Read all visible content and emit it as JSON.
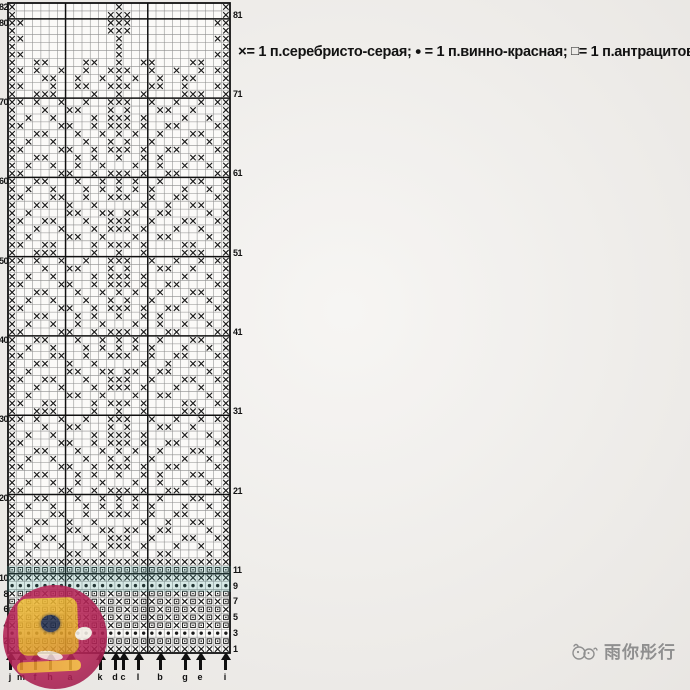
{
  "page": {
    "background": "#f2f0ed"
  },
  "legend": {
    "items": [
      {
        "symbol": "×",
        "icon": "x-stitch-icon",
        "label": "= 1 п.серебристо-серая;"
      },
      {
        "symbol": "•",
        "icon": "dot-stitch-icon",
        "label": "= 1 п.винно-красная;"
      },
      {
        "symbol": "□",
        "icon": "square-stitch-icon",
        "label": "= 1 п.антрацитовая"
      }
    ]
  },
  "watermark": {
    "text": "雨你彤行",
    "icon": "bird-doodle-icon",
    "color": "#8f8f8f"
  },
  "colors": {
    "symbol": "#1a1a1a",
    "grid_thin": "#8d8d8d",
    "grid_thick": "#101010",
    "chart_bg": "#fbfaf8",
    "teal_band": "rgba(74,165,160,0.20)",
    "sticker_magenta": "#b22355",
    "sticker_yellow": "#e2a32c"
  },
  "chart_data": {
    "type": "heatmap",
    "title": "",
    "description": "Knitting colorwork chart, 27 stitches x 82 rows; symbols: x = silver-gray stitch (×), o = wine-red stitch (•), s = anthracite stitch (□), . = empty",
    "columns": 27,
    "rows": 82,
    "row_numbers_left": [
      82,
      80,
      70,
      60,
      50,
      40,
      30,
      20,
      10,
      8,
      6,
      4,
      2
    ],
    "row_numbers_right": [
      81,
      71,
      61,
      51,
      41,
      31,
      21,
      11,
      9,
      7,
      5,
      3,
      1
    ],
    "thick_vertical_after_columns": [
      7,
      17
    ],
    "thick_horizontal_below_rows": [
      81,
      71,
      61,
      51,
      41,
      31,
      21,
      11
    ],
    "size_arrows": {
      "letters": [
        "j",
        "m",
        "f",
        "h",
        "a",
        "k",
        "d",
        "c",
        "l",
        "b",
        "g",
        "e",
        "i"
      ],
      "x_positions": [
        10,
        21,
        35,
        50,
        70,
        100,
        115,
        123,
        138,
        160,
        185,
        200,
        225
      ]
    },
    "pattern_rows_top_to_bottom": [
      "x............x............x",
      "x...........xxx...........x",
      "xx..........xxx..........xx",
      "x...........xxx...........x",
      "xx...........x...........xx",
      "x............x............x",
      "xx...........x...........xx",
      "x..xx....xx..x..xx....xx..x",
      "xx.x..x..x..xxx..x..x..x.xx",
      "x...xx..x..x.x.x..x..xx...x",
      "xx...x..xx..xxx..xx..x...xx",
      "x..xxx....x..x..x....xxx..x",
      "xx.x..x..x..xxx..x..x..x.xx",
      "x...x..xx...x.x...xx..x...x",
      "x.x..x....x.xxx.x....x..x.x",
      "xx....xx..x.xxx.x..xx....xx",
      "x..xx...x..x.x.x..x...xx..x",
      "x.x..x...x..x.x..x...x..x.x",
      "xx....xx..x.xxx.x..xx....xx",
      "x..xx...x.x..x..x.x...xx..x",
      "x.x..x..x..x...x..x..x..x.x",
      "xx....xx..x.xxx.x..xx....xx",
      "x..xx...x..x.x.x..x...xx..x",
      "x.x..x...x.x.x.x.x...x..x.x",
      "xx...xx..x..xxx..x..xx...xx",
      "x..xx..x..x.....x..x..xx..x",
      "x.x....xx..xx.xx..xx....x.x",
      "xx..xx...x..xxx..x...xx..xx",
      "x..x..x...x.xxx.x...x..x..x",
      "x.x....xx..x...x..xx....x.x",
      "xx..xx....x.xxx.x....xx..xx",
      "x..xxx....x..x..x....xxx..x",
      "xx.x..x..x..xxx..x..x..x.xx",
      "x...x..xx...x.x...xx..x...x",
      "x.x..x....x.xxx.x....x..x.x",
      "xx....xx..x.xxx.x..xx....xx",
      "x..xx...x..x.x.x..x...xx..x",
      "x.x..x...x..x.x..x...x..x.x",
      "xx....xx..x.xxx.x..xx....xx",
      "x..xx...x.x..x..x.x...xx..x",
      "x.x..x..x..x...x..x..x..x.x",
      "xx....xx..x.xxx.x..xx....xx",
      "x..xx...x..x.x.x..x...xx..x",
      "x.x..x...x.x.x.x.x...x..x.x",
      "xx...xx..x..xxx..x..xx...xx",
      "x..xx..x..x.....x..x..xx..x",
      "x.x....xx..xx.xx..xx....x.x",
      "xx..xx...x..xxx..x...xx..xx",
      "x..x..x...x.xxx.x...x..x..x",
      "x.x....xx..x...x..xx....x.x",
      "xx..xx....x.xxx.x....xx..xx",
      "x..xxx....x..x..x....xxx..x",
      "xx.x..x..x..xxx..x..x..x.xx",
      "x...x..xx...x.x...xx..x...x",
      "x.x..x....x.xxx.x....x..x.x",
      "xx....xx..x.xxx.x..xx....xx",
      "x..xx...x..x.x.x..x...xx..x",
      "x.x..x...x..x.x..x...x..x.x",
      "xx....xx..x.xxx.x..xx....xx",
      "x..xx...x.x..x..x.x...xx..x",
      "x.x..x..x..x...x..x..x..x.x",
      "xx....xx..x.xxx.x..xx....xx",
      "x..xx...x..x.x.x..x...xx..x",
      "x.x..x...x.x.x.x.x...x..x.x",
      "xx...xx..x..xxx..x..xx...xx",
      "x..xx..x..x.....x..x..xx..x",
      "x.x....xx..xx.xx..xx....x.x",
      "xx..xx...x..xxx..x...xx..xx",
      "x..x..x...x.xxx.x...x..x..x",
      "x.x....xx..x...x..xx....x.x",
      "xxxxxxxxxxxxxxxxxxxxxxxxxxx",
      "sssssssssssssssssssssssssss",
      "xxxxxxxxxxxxxxxxxxxxxxxxxxx",
      "ooooooooooooooooooooooooooo",
      "xsssxsssxsssxsssxsssxsssxss",
      "sxsxsxsxsxsxsxsxsxsxsxsxsxs",
      "ssxsssxsssxsssxsssxsssxsssx",
      "sxsxsxsxsxsxsxsxsxsxsxsxsxs",
      "xsssxsssxsssxsssxsssxsssxss",
      "ooooooooooooooooooooooooooo",
      "sssssssssssssssssssssssssss",
      "xxxxxxxxxxxxxxxxxxxxxxxxxxx"
    ]
  }
}
